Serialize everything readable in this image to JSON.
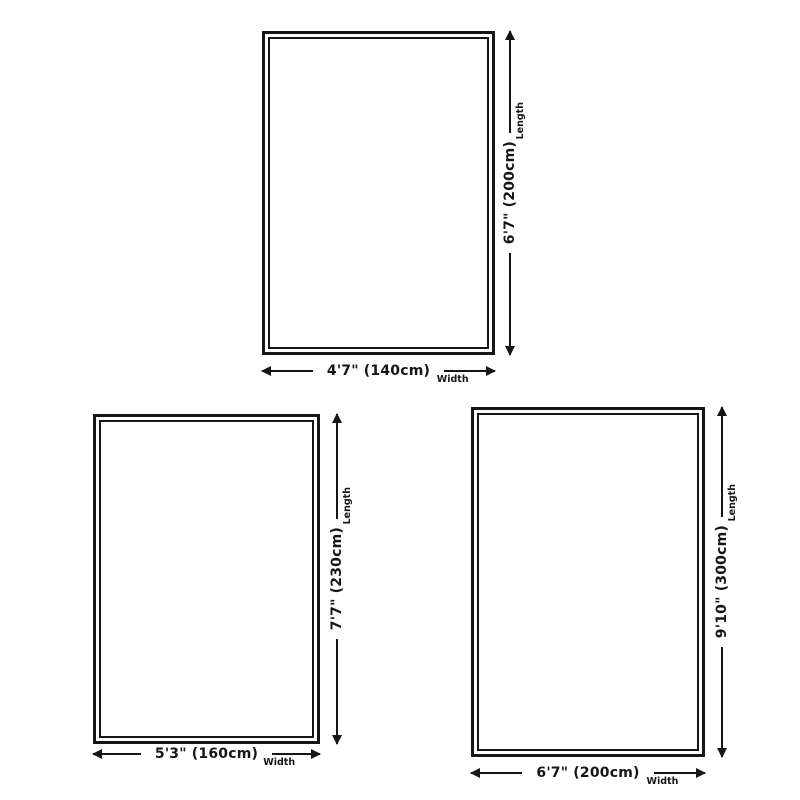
{
  "page": {
    "background": "#ffffff",
    "ink": "#161616",
    "description": "Rug size diagrams with length and width dimension arrows"
  },
  "figures": [
    {
      "id": "top-center",
      "length_text": "6'7\" (200cm)",
      "width_text": "4'7\" (140cm)",
      "length_label": "Length",
      "width_label": "Width"
    },
    {
      "id": "bottom-left",
      "length_text": "7'7\" (230cm)",
      "width_text": "5'3\" (160cm)",
      "length_label": "Length",
      "width_label": "Width"
    },
    {
      "id": "bottom-right",
      "length_text": "9'10\" (300cm)",
      "width_text": "6'7\" (200cm)",
      "length_label": "Length",
      "width_label": "Width"
    }
  ]
}
